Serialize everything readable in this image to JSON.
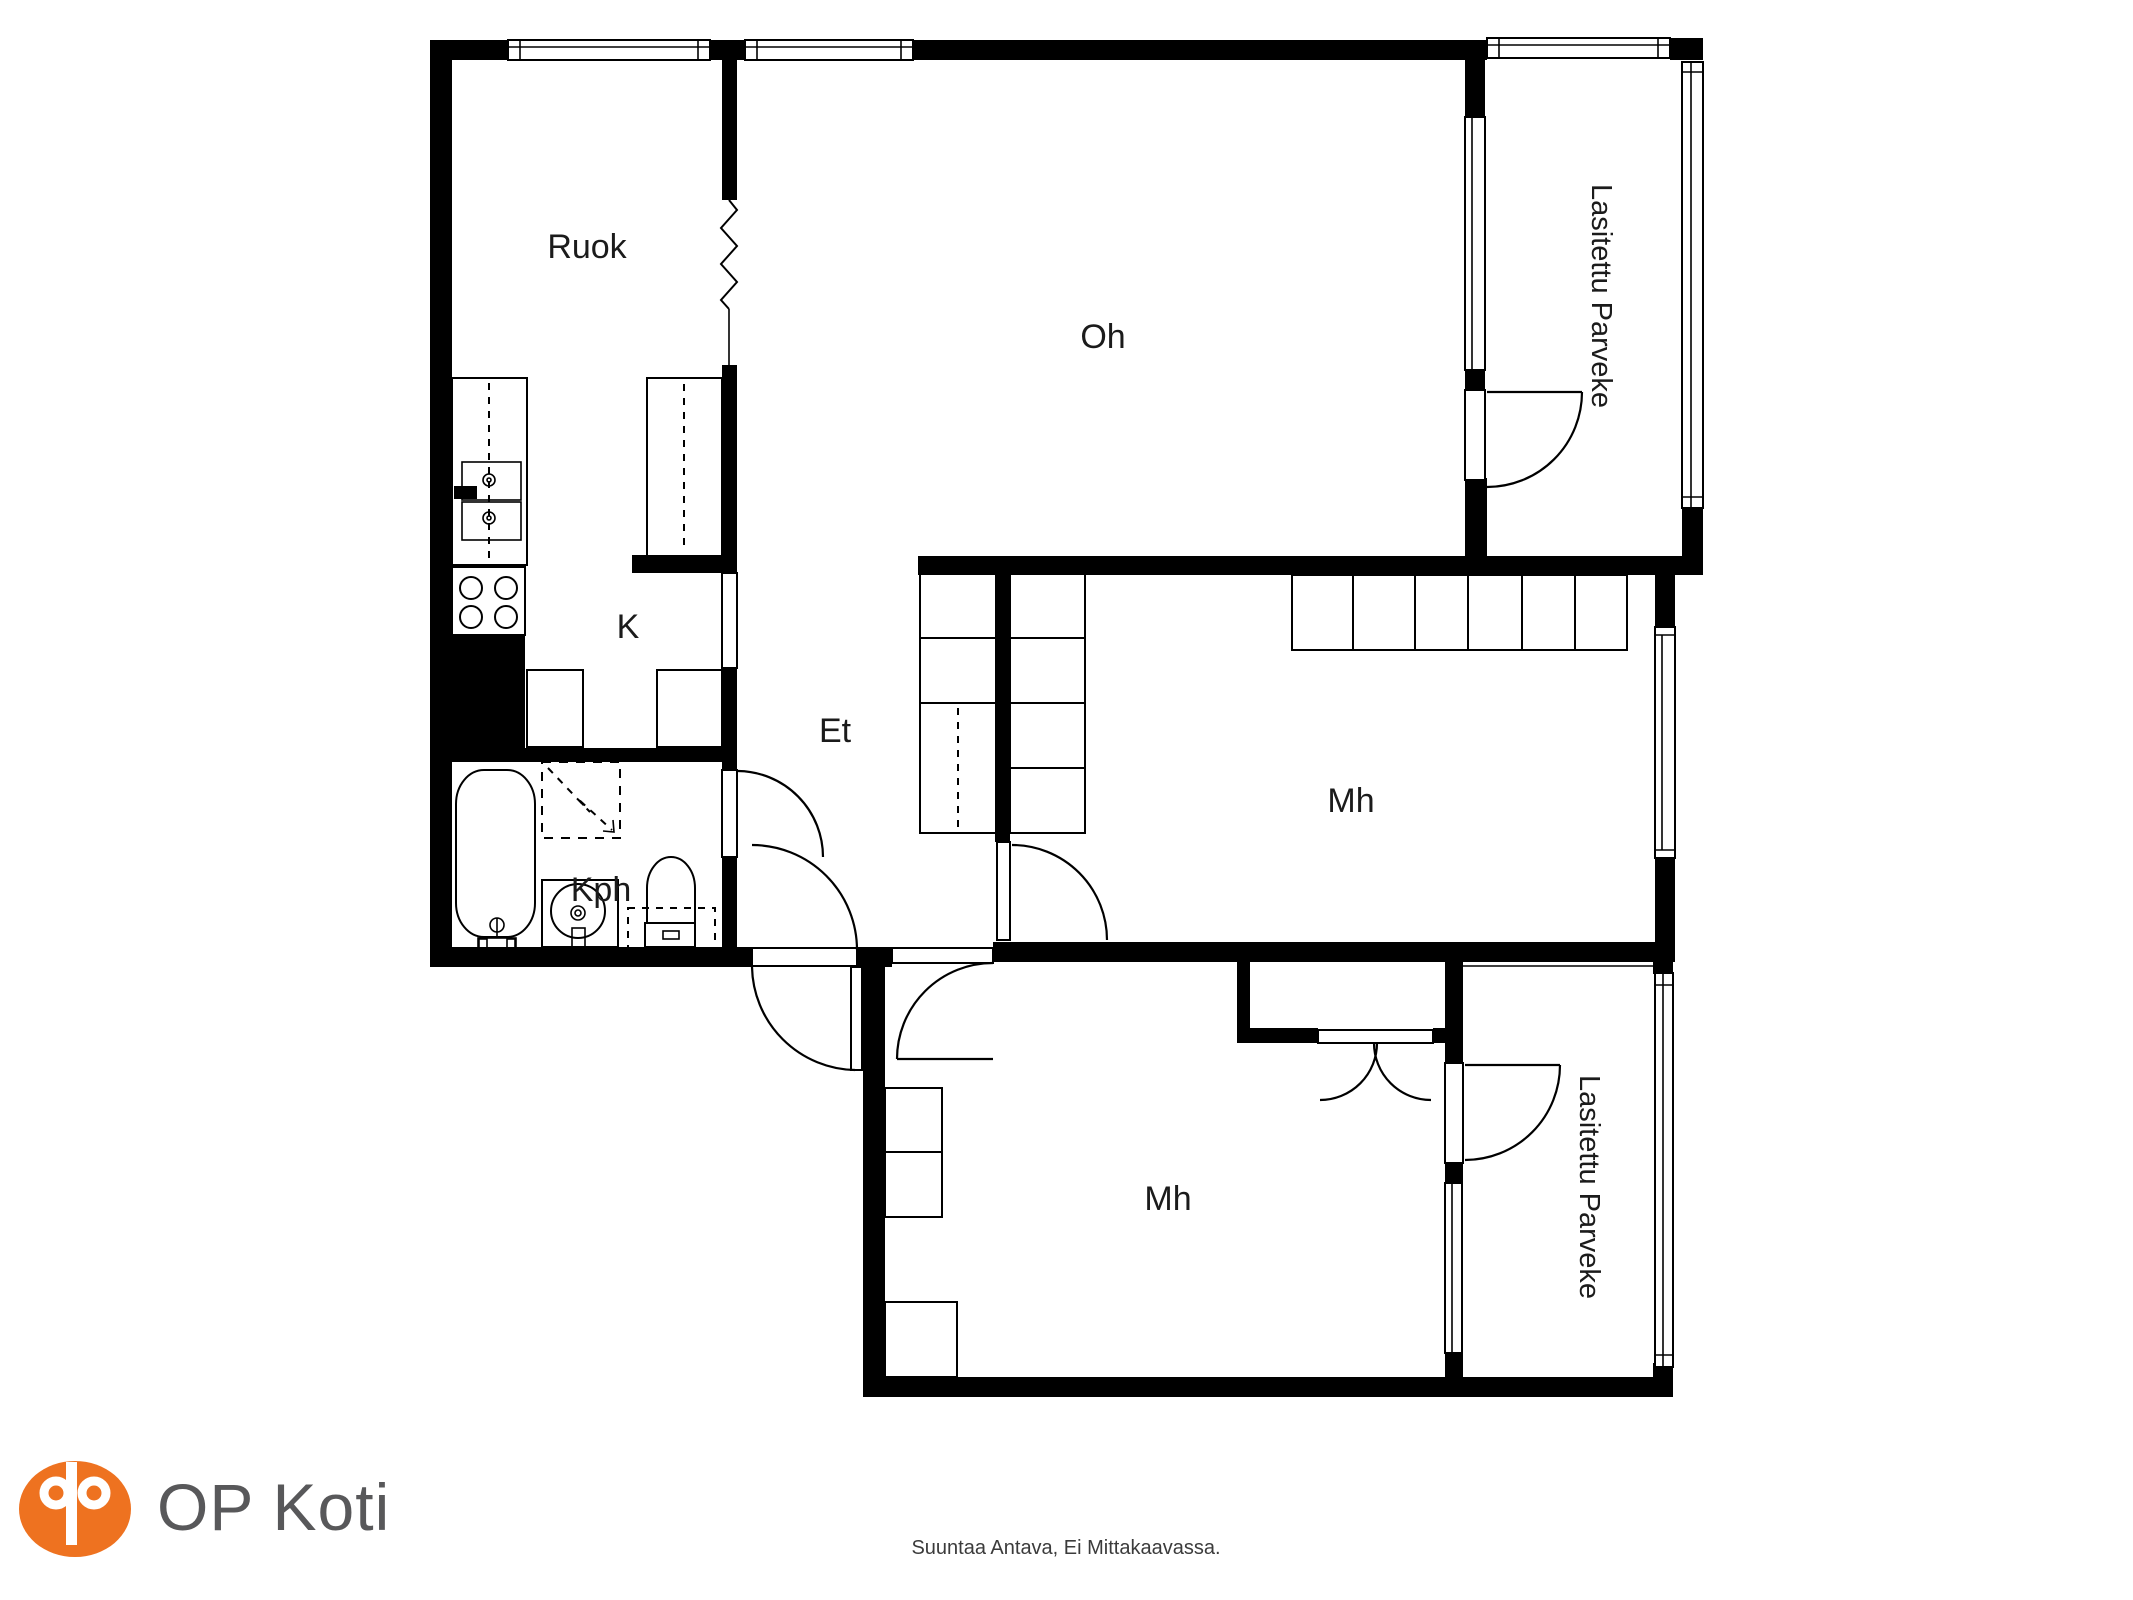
{
  "floorplan": {
    "rooms": {
      "dining": {
        "label": "Ruok"
      },
      "living": {
        "label": "Oh"
      },
      "kitchen": {
        "label": "K"
      },
      "entry": {
        "label": "Et"
      },
      "bathroom": {
        "label": "Kph"
      },
      "bedroom_right": {
        "label": "Mh"
      },
      "bedroom_bottom": {
        "label": "Mh"
      },
      "balcony_top": {
        "label": "Lasitettu Parveke"
      },
      "balcony_bottom": {
        "label": "Lasitettu Parveke"
      }
    },
    "colors": {
      "wall": "#000000",
      "background": "#ffffff",
      "label": "#1b1b1b"
    }
  },
  "branding": {
    "logo_text": "OP Koti",
    "logo_color": "#ee7220",
    "logo_text_color": "#58585a"
  },
  "footer": {
    "disclaimer": "Suuntaa Antava, Ei Mittakaavassa."
  }
}
